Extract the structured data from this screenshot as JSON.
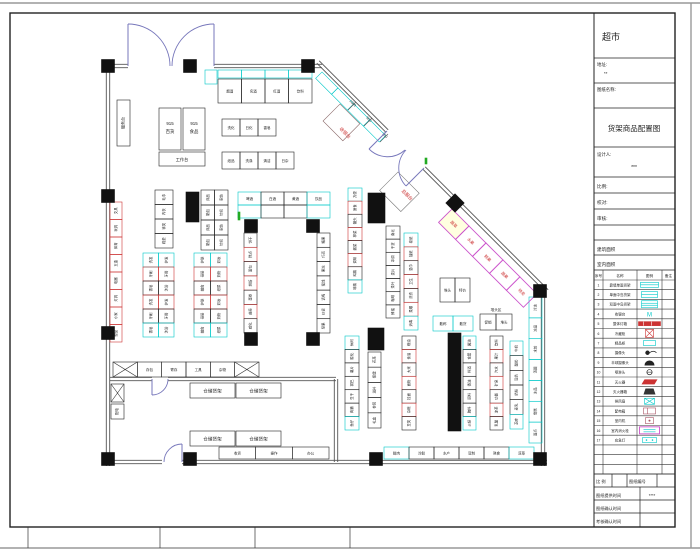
{
  "sheet": {
    "title_block": {
      "store_name": "超市",
      "address_label": "地址:",
      "address_value": "**",
      "drawing_name_label": "图纸名称:",
      "drawing_title": "货架商品配置图",
      "designer_label": "设计人:",
      "designer_value": "***",
      "scale_label": "比例:",
      "check_label": "校对:",
      "audit_label": "审核:",
      "building_area_label": "建筑面积",
      "interior_area_label": "室内面积",
      "legend": {
        "headers": [
          "序号",
          "名称",
          "图例",
          "备注"
        ],
        "rows": [
          {
            "no": "1",
            "name": "靠墙单面货架",
            "icon": "cyan-wall-shelf"
          },
          {
            "no": "2",
            "name": "单面中岛货架",
            "icon": "cyan-island-shelf"
          },
          {
            "no": "3",
            "name": "双面中岛货架",
            "icon": "cyan-end-shelf"
          },
          {
            "no": "4",
            "name": "收银台",
            "icon": "m-text"
          },
          {
            "no": "5",
            "name": "整体灯箱",
            "icon": "red-lightbox"
          },
          {
            "no": "6",
            "name": "冷藏柜",
            "icon": "red-freezer"
          },
          {
            "no": "7",
            "name": "精品柜",
            "icon": "cyan-boutique"
          },
          {
            "no": "8",
            "name": "摄像头",
            "icon": "camera"
          },
          {
            "no": "9",
            "name": "半球摄像头",
            "icon": "dome"
          },
          {
            "no": "10",
            "name": "喷淋头",
            "icon": "sprinkler"
          },
          {
            "no": "11",
            "name": "灭火器",
            "icon": "red-extinguisher"
          },
          {
            "no": "12",
            "name": "灭火器箱",
            "icon": "dark-box"
          },
          {
            "no": "13",
            "name": "排风扇",
            "icon": "cyan-fan"
          },
          {
            "no": "14",
            "name": "配电箱",
            "icon": "red-power"
          },
          {
            "no": "15",
            "name": "室内机",
            "icon": "red-indoor"
          },
          {
            "no": "16",
            "name": "室内消火栓",
            "icon": "magenta-hydrant"
          },
          {
            "no": "17",
            "name": "应急灯",
            "icon": "cyan-emergency"
          }
        ]
      },
      "footer": {
        "scale_label": "比 例",
        "drawing_no_label": "图纸编号",
        "provide_label": "图纸提供时间",
        "provide_value": "****",
        "confirm_label": "图纸确认时间",
        "review_label": "考核确认时间"
      }
    },
    "plan": {
      "storage_label": "仓储货架",
      "cashier_label": "收银台",
      "service_desk_label": "总服台",
      "service_box_label": "服务台",
      "workbench_label": "工作台",
      "power_label": "配电",
      "area_label": "堆头区",
      "block_915_left": {
        "line1": "915",
        "line2": "百货"
      },
      "block_915_right": {
        "line1": "915",
        "line2": "食品"
      },
      "dims": [
        "1060",
        "950",
        "750"
      ],
      "labels": {
        "top_wall": [
          "烟酒",
          "名酒",
          "红酒",
          "饮料"
        ],
        "top_rows3": [
          "洗化",
          "日化",
          "香皂"
        ],
        "top_rows4": [
          "纸品",
          "洗涤",
          "清洁",
          "日杂"
        ],
        "ladder1": [
          "毛巾",
          "内衣",
          "袜类",
          "鞋垫"
        ],
        "ladder2": [
          "床品",
          "家纺",
          "箱包",
          "针织"
        ],
        "ladder3": [
          "洗发",
          "护发",
          "牙刷",
          "牙膏",
          "香皂",
          "沐浴"
        ],
        "ladder4": [
          "护肤",
          "彩妆",
          "母婴",
          "奶粉",
          "辅食",
          "纸尿"
        ],
        "u_top": [
          "啤酒",
          "白酒",
          "黄酒",
          "饮品"
        ],
        "u_left": [
          "饼干",
          "糕点",
          "面包",
          "烘焙",
          "蛋卷",
          "曲奇",
          "威化"
        ],
        "u_right": [
          "糖果",
          "巧克",
          "果冻",
          "蜜饯",
          "话梅",
          "炒货",
          "坚果"
        ],
        "run348": [
          "方便",
          "速食",
          "罐头",
          "榨菜",
          "酱菜",
          "调味",
          "鸡精",
          "味精"
        ],
        "run386": [
          "南北",
          "干货",
          "冲调",
          "麦片",
          "茶叶",
          "咖啡",
          "蜂蜜"
        ],
        "run404": [
          "卷纸",
          "抽纸",
          "湿巾",
          "卫生",
          "洗衣",
          "柔顺",
          "消毒",
          "芳香"
        ],
        "duitou": [
          "堆头",
          "特价"
        ],
        "hrun": [
          "散称",
          "散货"
        ],
        "duitou2": [
          "促销",
          "堆头"
        ],
        "b1": [
          "休闲",
          "膨化",
          "薯片",
          "锅巴",
          "豆干",
          "肉脯",
          "鱼仔"
        ],
        "b2": [
          "花茶",
          "保健",
          "滋补",
          "参茸",
          "礼盒"
        ],
        "b3": [
          "粮油",
          "食油",
          "大米",
          "面粉",
          "挂面",
          "杂粮",
          "豆类"
        ],
        "b4": [
          "酱油",
          "食醋",
          "料酒",
          "香油",
          "调料",
          "腌料",
          "火锅"
        ],
        "b5": [
          "饮料",
          "果汁",
          "汽水",
          "矿泉",
          "功能",
          "凉茶",
          "乳酸"
        ],
        "b6": [
          "牛奶",
          "酸奶",
          "豆奶",
          "奶粉",
          "麦乳",
          "芝麻"
        ],
        "right_wall": [
          "冷冻",
          "冻品",
          "水饺",
          "汤圆",
          "冰品",
          "雪糕",
          "面点"
        ],
        "bottom_right": [
          "鲜肉",
          "冷鲜",
          "水产",
          "豆制",
          "熟食",
          "凉菜"
        ],
        "bottom_mid": [
          "收货",
          "操作",
          "办公"
        ],
        "left_wall": [
          "文具",
          "玩具",
          "体育",
          "五金",
          "电器",
          "灯具",
          "小家",
          "塑品"
        ],
        "wh_row": [
          "存包",
          "寄存",
          "工具",
          "杂物"
        ],
        "diag": [
          "蔬菜",
          "水果",
          "鲜果",
          "蔬果",
          "特卖"
        ]
      }
    },
    "colors": {
      "cyan": "#00c8c8",
      "red": "#cc3333",
      "magenta": "#cc55cc",
      "wall": "#555555",
      "door": "#7777bb",
      "black_fill": "#111111"
    }
  }
}
